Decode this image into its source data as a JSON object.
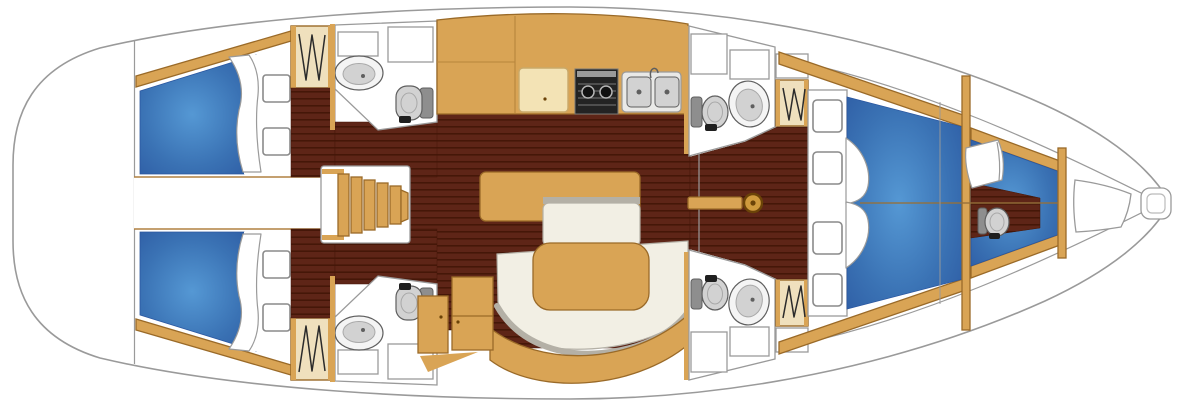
{
  "canvas": {
    "width": 1200,
    "height": 414
  },
  "diagram_type": "sailing-yacht-interior-floor-plan",
  "orientation": {
    "bow": "right",
    "stern": "left",
    "port": "top",
    "starboard": "bottom"
  },
  "colors": {
    "deck_white": "#ffffff",
    "hull_stroke": "#9a9a9a",
    "box_stroke": "#9a9a9a",
    "hatch_stroke": "#8a8a8a",
    "corridor_line": "#b08040",
    "floor_base": "#5e2517",
    "floor_line": "#451708",
    "wood_tan": "#d9a455",
    "wood_tan_stroke": "#9a6a28",
    "galley_seam": "#b8863c",
    "cream": "#f3e3b5",
    "cream_stroke": "#c9a96a",
    "locker_cream": "#efe0bd",
    "zigzag_dark": "#2b2b2b",
    "berth_blue_light": "#5598d4",
    "berth_blue_mid": "#3a72b4",
    "berth_blue_dark": "#2b57a0",
    "pillow_stroke": "#9a9a9a",
    "seat_white": "#f2efe4",
    "seat_trim": "#b4b0a6",
    "fixture_light": "#f4f4f4",
    "fixture_fill": "#d2d2d2",
    "fixture_dark": "#8e8e8e",
    "fixture_stroke": "#5f5f5f",
    "fixture_inner_stroke": "#a8a8a8",
    "stove_black": "#232323",
    "stove_grey": "#9a9a9a",
    "sink_unit": "#e9e9e7",
    "steel": "#d2d2d2",
    "base_black": "#1f1f1f",
    "mast_gold": "#cf9a3d",
    "mast_ring": "#6b4308",
    "split_line": "#96713a"
  },
  "areas": [
    "cockpit-stern",
    "aft-cabin-port",
    "aft-cabin-starboard",
    "engine-corridor",
    "companionway-steps",
    "aft-head-port",
    "aft-head-starboard",
    "galley",
    "saloon-settee",
    "saloon-tables",
    "nav-cabinets",
    "mast-step",
    "forward-head-port",
    "forward-head-starboard",
    "forward-cabin-v-berth",
    "bow-cabin",
    "anchor-locker"
  ],
  "fixtures": [
    "toilet",
    "washbasin",
    "two-burner-stove",
    "double-sink",
    "hanging-locker",
    "berth-cushion",
    "pillow",
    "cabin-hatch",
    "deck-hatch",
    "anchor-roller"
  ]
}
